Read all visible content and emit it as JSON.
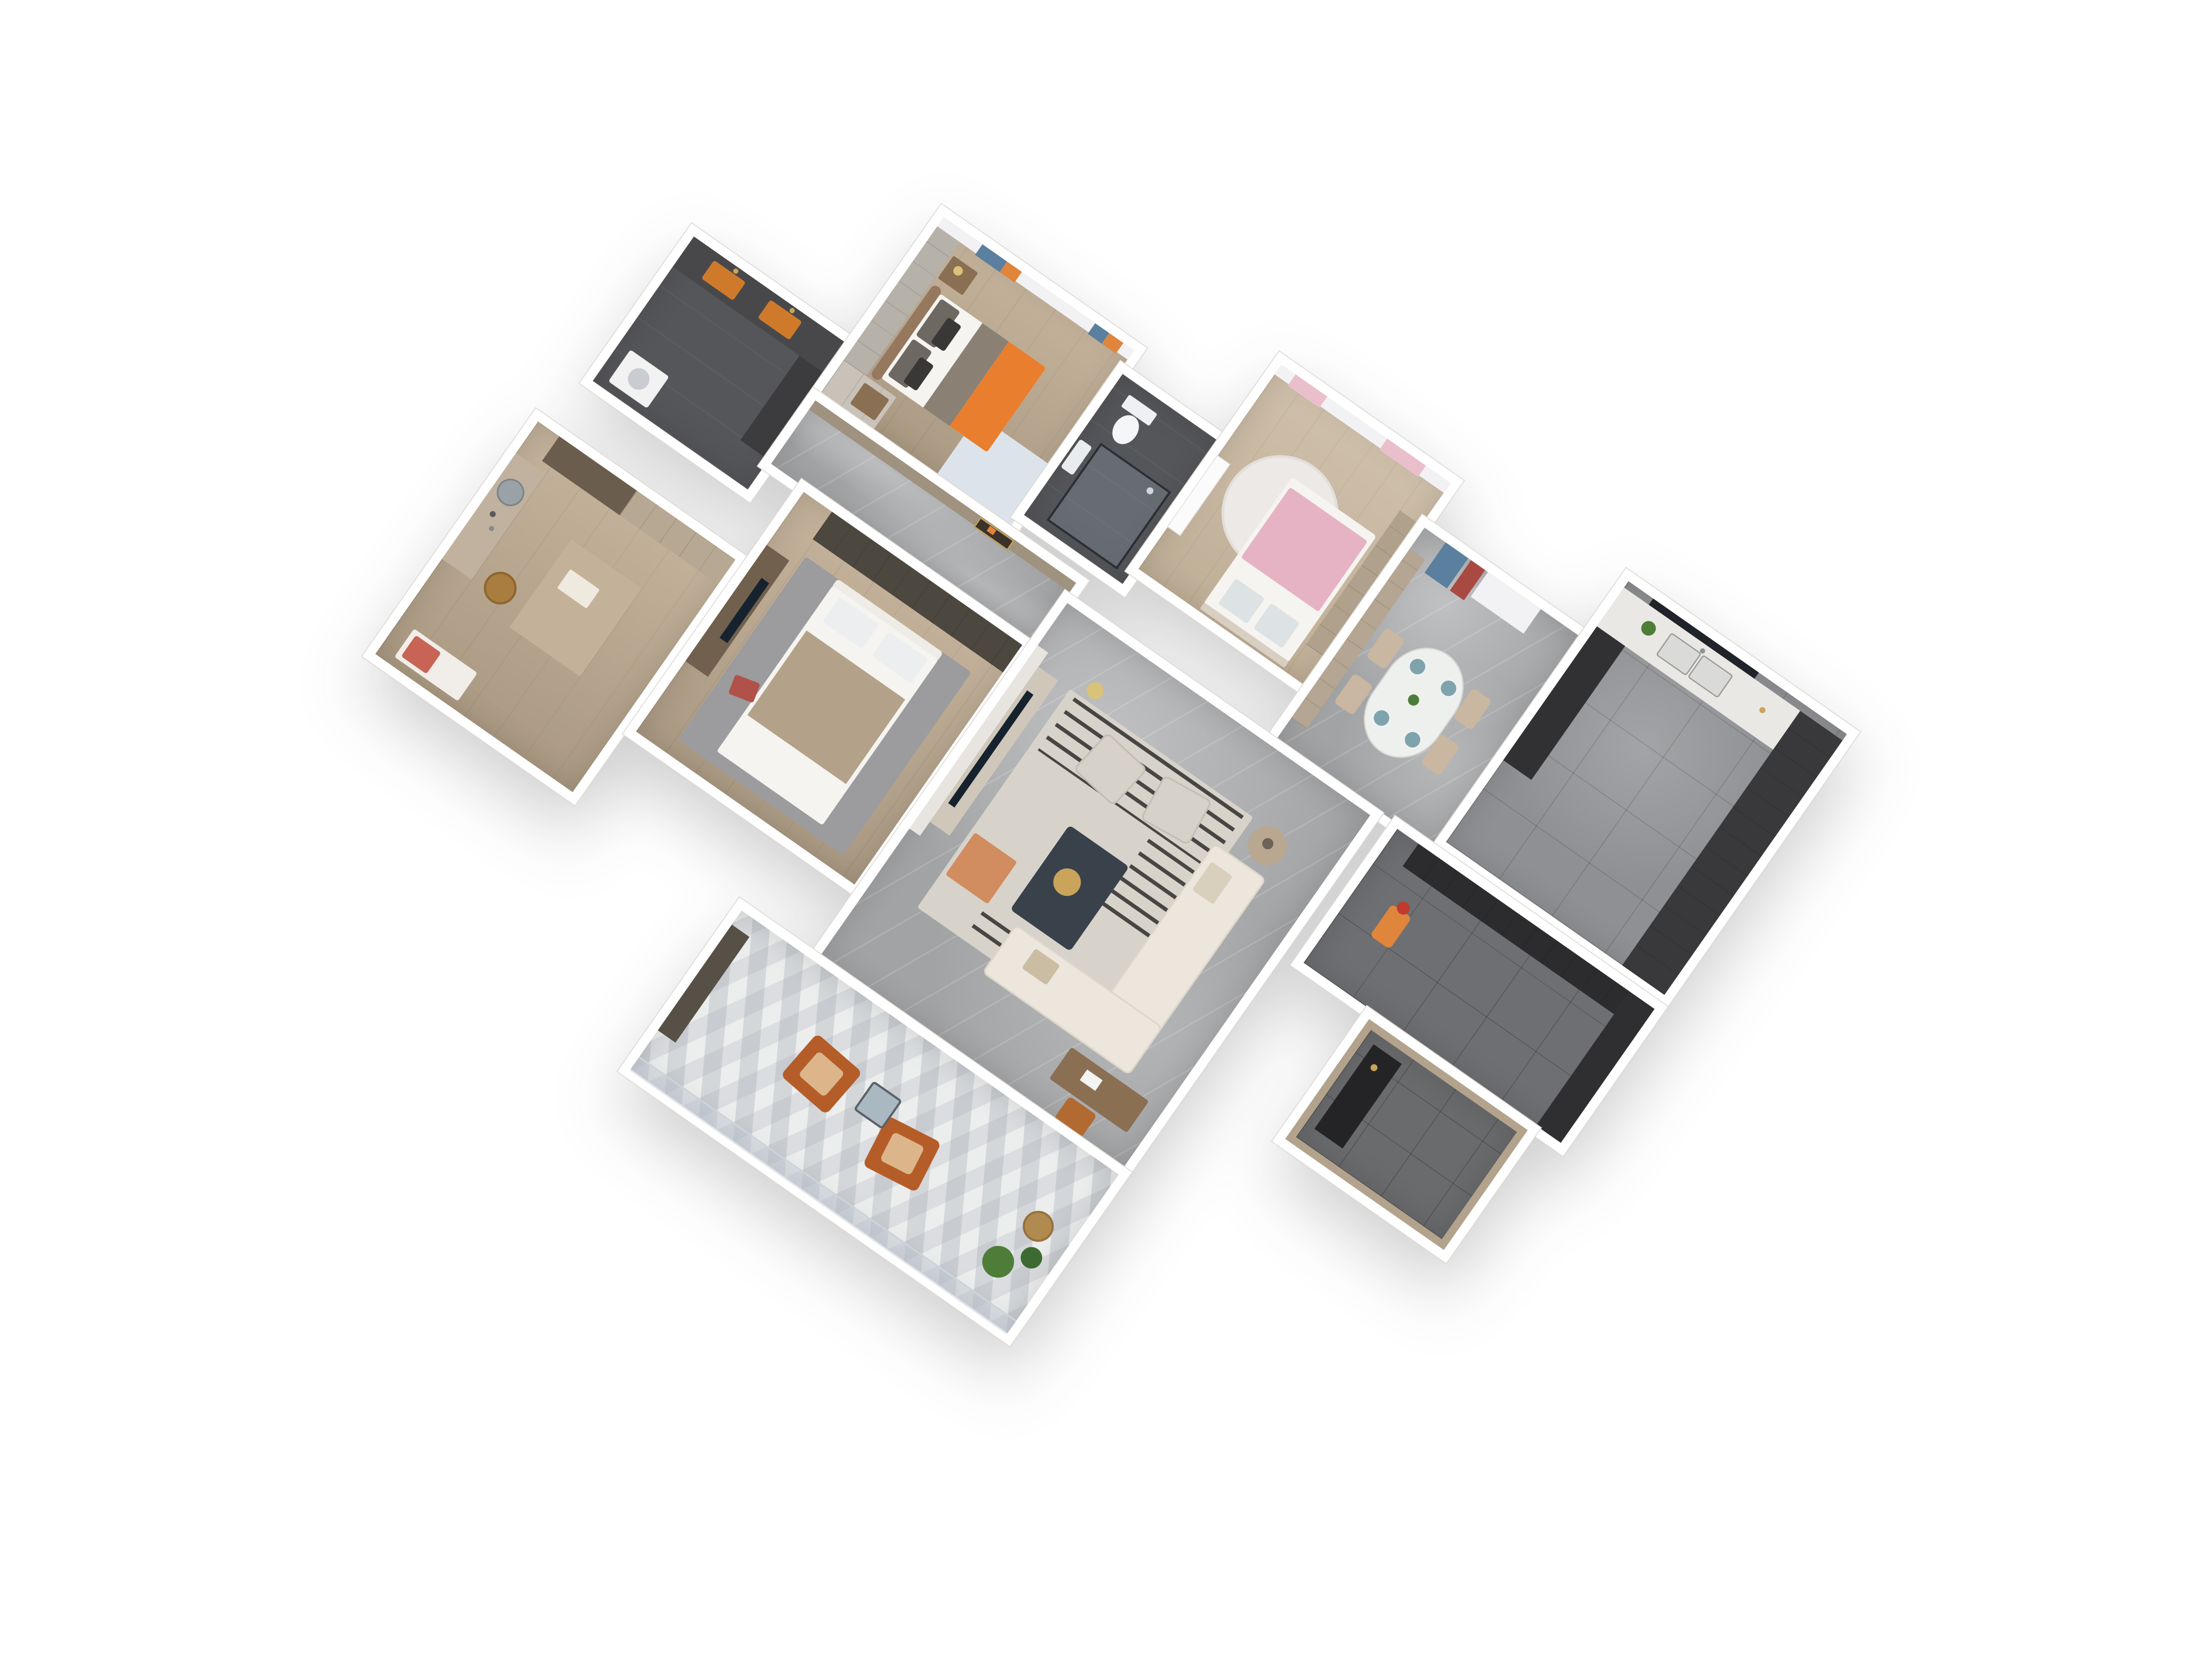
{
  "scene": {
    "type": "3d-floor-plan-render",
    "description": "Top-down axonometric 3D render of a furnished 3-bedroom apartment on a white background, rotated about 35 degrees",
    "background": "#ffffff",
    "rotation_deg": 35
  },
  "palette": {
    "wall": "#ffffff",
    "wall-edge": "#dcd9d4",
    "wood": "#c4b29b",
    "wood-dark": "#ab9a83",
    "marble-gray": "#a2a3a5",
    "tile-dark": "#6e6f72",
    "bath-floor": "#55565a",
    "balcony-tile": "#eceded",
    "curtain-sheer": "#f2f2f4",
    "curtain-blue": "#5b7f9e",
    "curtain-orange": "#e0853c",
    "curtain-pink": "#eabfcc",
    "bed-orange": "#e87e2e",
    "bed-white": "#f6f4f0",
    "pillow-dark": "#6e6862",
    "headboard": "#96785f",
    "rug-blue": "#dde3ea",
    "rug-living": "#d7d3cb",
    "rug-stripe": "#2f2d2b",
    "rug-orange": "#d07b43",
    "rug-gray": "#9c9c9e",
    "pink-blanket": "#e5b3c3",
    "tan-blanket": "#b3a289",
    "sofa": "#ece6dc",
    "table-dark": "#39414b",
    "chair-beige": "#c9b7a2",
    "armchair-orange": "#b55d28",
    "kitchen-counter": "#eae8e4",
    "cabinet-dark": "#39393c",
    "cabinet-black": "#2c2b2d",
    "wood-cabinet": "#b0a18c",
    "tv-screen": "#16222e",
    "glass": "#aab8c2",
    "plant": "#4e7d3a",
    "accent-gold": "#c9a45a",
    "vanity-orange": "#cf7a2a",
    "wardrobe-panel": "#b6b1a9",
    "door-white": "#fbfbfb"
  },
  "rooms": [
    {
      "id": "bathroom",
      "label": "bathroom with double orange vanity sinks and washer",
      "floor": "dark tile",
      "furniture": [
        "vanity-counter",
        "orange-sink",
        "orange-sink",
        "washing-machine",
        "storage-column"
      ]
    },
    {
      "id": "master-bedroom",
      "label": "master bedroom with orange blanket bed, wardrobe and blue-orange curtains",
      "floor": "wood",
      "furniture": [
        "double-bed",
        "headboard",
        "pillows",
        "orange-blanket",
        "nightstand",
        "lamp",
        "wardrobe",
        "blue-rug",
        "curtains"
      ]
    },
    {
      "id": "shower-room",
      "label": "ensuite shower room with glass shower cabin and toilet",
      "floor": "dark tile",
      "furniture": [
        "glass-shower-cabin",
        "toilet",
        "wash-basin"
      ]
    },
    {
      "id": "kids-bedroom",
      "label": "kids bedroom with pink bedding, round rug and pink curtains",
      "floor": "wood",
      "furniture": [
        "single-bed",
        "pink-blanket",
        "round-rug",
        "wardrobe",
        "door",
        "curtains"
      ]
    },
    {
      "id": "dining-room",
      "label": "dining room with oval table, four beige chairs and hanging blue and red towels",
      "floor": "gray marble",
      "furniture": [
        "oval-dining-table",
        "dining-chair",
        "dining-chair",
        "dining-chair",
        "dining-chair",
        "place-settings",
        "plant",
        "towels"
      ]
    },
    {
      "id": "kitchen",
      "label": "kitchen with white marble counter, double sink and dark tall cabinets",
      "floor": "gray tile",
      "furniture": [
        "counter",
        "double-sink",
        "window",
        "tall-cabinets",
        "base-cabinet",
        "plant"
      ]
    },
    {
      "id": "hallway",
      "label": "hallway with wood paneling and lit display niche",
      "floor": "gray marble",
      "furniture": [
        "wall-niche"
      ]
    },
    {
      "id": "study",
      "label": "study and cloakroom with desk island, rattan stool, vanity mirror and wardrobe",
      "floor": "wood",
      "furniture": [
        "wardrobe",
        "vanity-table",
        "mirror",
        "desk-island",
        "tray",
        "rattan-stool",
        "bench"
      ]
    },
    {
      "id": "second-bedroom",
      "label": "second bedroom with tan blanket bed, gray rug, TV dresser and dark wardrobe",
      "floor": "wood",
      "furniture": [
        "double-bed",
        "tan-blanket",
        "pillows",
        "red-pillow",
        "gray-rug",
        "tv-dresser",
        "tv",
        "wardrobe"
      ]
    },
    {
      "id": "living-room",
      "label": "living room with white sectional sofa, dark coffee table, striped rug, two accent chairs, TV wall and desk",
      "floor": "gray marble",
      "furniture": [
        "tv-wall",
        "tv-console",
        "tv",
        "striped-rug",
        "accent-chair",
        "accent-chair",
        "coffee-table",
        "gold-tray",
        "sectional-sofa",
        "round-side-table",
        "desk",
        "office-chair",
        "floor-lamp"
      ]
    },
    {
      "id": "entry-corridor",
      "label": "entry corridor with black shoe cabinets and orange stick vacuum",
      "floor": "dark tile",
      "furniture": [
        "shoe-cabinet",
        "tall-cabinet",
        "stick-vacuum"
      ]
    },
    {
      "id": "entry-foyer",
      "label": "entrance foyer with wood threshold and black console",
      "floor": "dark tile",
      "furniture": [
        "console-cabinet"
      ]
    },
    {
      "id": "balcony",
      "label": "balcony with two cognac leather armchairs, glass side table, plants and glass railing",
      "floor": "light geometric tile",
      "furniture": [
        "armchair",
        "armchair",
        "glass-side-table",
        "potted-plant",
        "potted-plant",
        "rattan-basket",
        "glass-railing",
        "side-cabinet"
      ]
    }
  ]
}
